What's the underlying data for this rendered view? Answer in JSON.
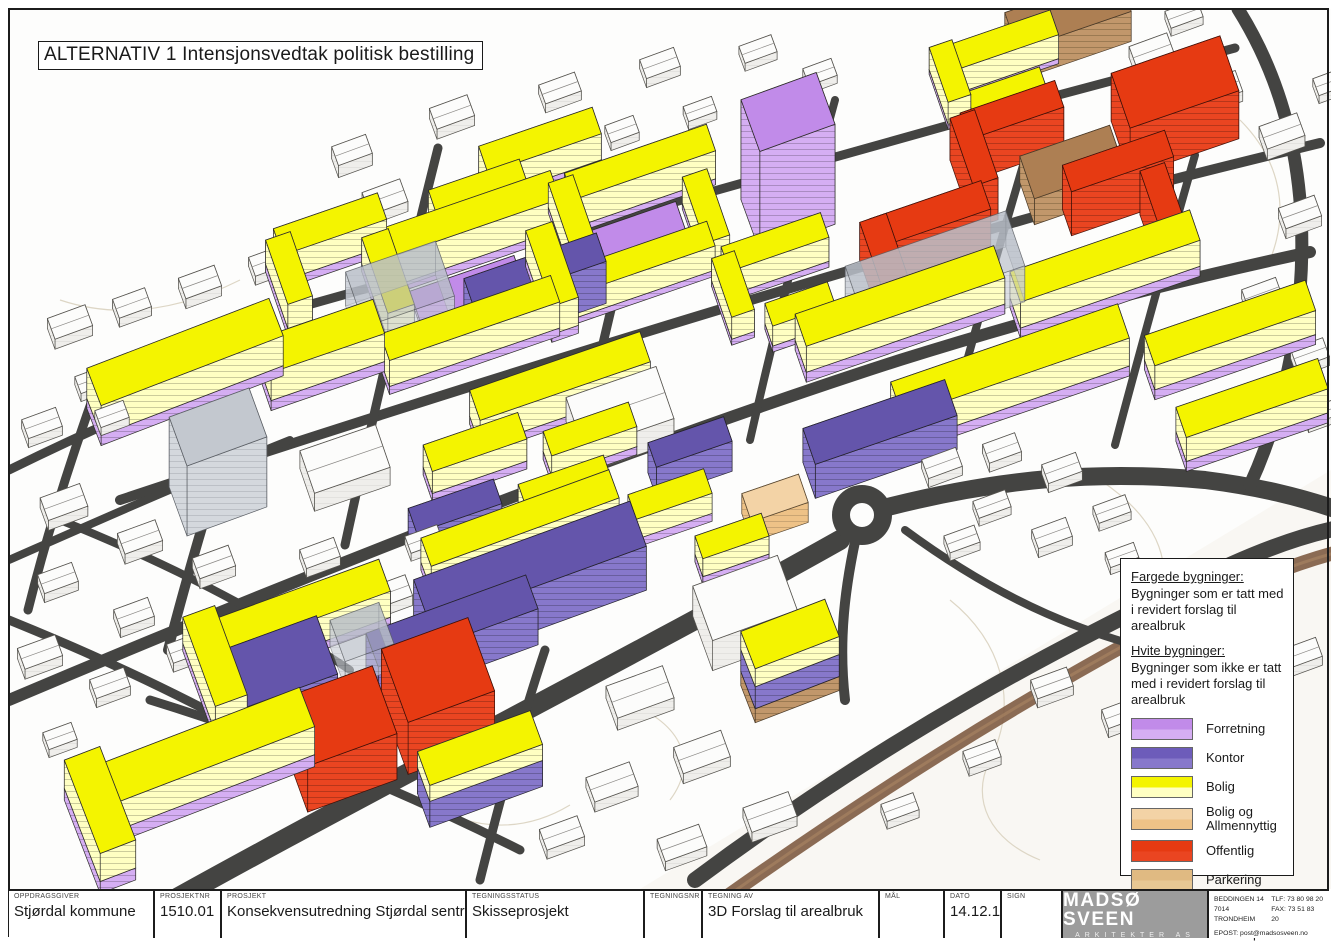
{
  "title": "ALTERNATIV 1 Intensjonsvedtak politisk bestilling",
  "legend": {
    "colored_header": "Fargede bygninger:",
    "colored_desc": "Bygninger som er tatt med i revidert forslag til arealbruk",
    "white_header": "Hvite bygninger:",
    "white_desc": "Bygninger som ikke er tatt med i revidert forslag til arealbruk",
    "items": [
      {
        "label": "Forretning",
        "color": "#c18be9",
        "color2": "#d5aef3"
      },
      {
        "label": "Kontor",
        "color": "#6d5cba",
        "color2": "#8778cb"
      },
      {
        "label": "Bolig",
        "color": "#f4f400",
        "color2": "#ffffc2"
      },
      {
        "label": "Bolig og Allmennyttig",
        "color": "#f3d3a6",
        "color2": "#eec287"
      },
      {
        "label": "Offentlig",
        "color": "#e63a12",
        "color2": "#ea4521"
      },
      {
        "label": "Parkering",
        "color": "#e0ba82",
        "color2": "#e7c894"
      },
      {
        "label": "Foreslås fjernet i revidert plan",
        "color": "#d7dadf",
        "color2": "#e4e7eb"
      }
    ]
  },
  "titleblock": {
    "fields": [
      {
        "label": "OPPDRAGSGIVER",
        "value": "Stjørdal kommune",
        "w": 146
      },
      {
        "label": "PROSJEKTNR",
        "value": "1510.01",
        "w": 67
      },
      {
        "label": "PROSJEKT",
        "value": "Konsekvensutredning Stjørdal sentrum",
        "w": 245
      },
      {
        "label": "TEGNINGSSTATUS",
        "value": "Skisseprosjekt",
        "w": 178
      },
      {
        "label": "TEGNINGSNR",
        "value": "",
        "w": 58
      },
      {
        "label": "TEGNING AV",
        "value": "3D Forslag til arealbruk",
        "w": 177
      },
      {
        "label": "MÅL",
        "value": "",
        "w": 65
      },
      {
        "label": "DATO",
        "value": "14.12.15",
        "w": 57
      },
      {
        "label": "SIGN",
        "value": "",
        "w": 61
      }
    ],
    "logo": {
      "name": "MADSØ SVEEN",
      "sub": "ARKITEKTER AS"
    },
    "contact": {
      "address1": "BEDDINGEN 14",
      "address2": "7014 TRONDHEIM",
      "tlf": "TLF: 73 80 98 20",
      "fax": "FAX: 73 51 83 20",
      "email": "EPOST: post@madsosveen.no"
    }
  }
}
